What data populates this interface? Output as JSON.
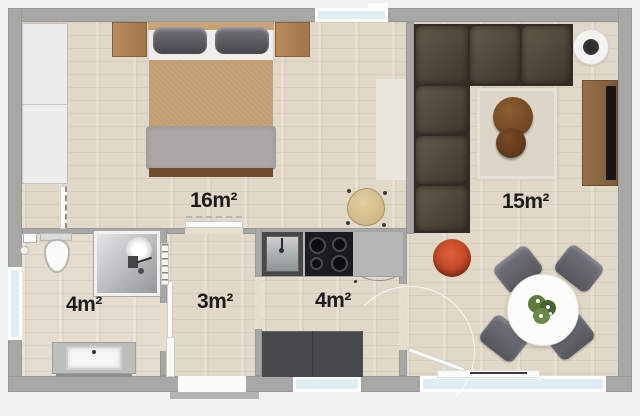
{
  "plan": {
    "rooms": [
      {
        "name": "bedroom",
        "area_label": "16m²"
      },
      {
        "name": "living-room",
        "area_label": "15m²"
      },
      {
        "name": "bathroom",
        "area_label": "4m²"
      },
      {
        "name": "hallway",
        "area_label": "3m²"
      },
      {
        "name": "kitchen",
        "area_label": "4m²"
      }
    ],
    "colors": {
      "floor_wood": "#e2d8c7",
      "wall_gray": "#a7a7a5",
      "window_glass": "#dfeef1",
      "sofa_dark": "#4a4236",
      "bed_blanket_tan": "#c29d71",
      "bed_blanket_gray": "#a9a8a6",
      "pouf_red": "#c8502e",
      "coffee_table_brown": "#6f4523",
      "label_text": "#1c1c1c"
    }
  }
}
